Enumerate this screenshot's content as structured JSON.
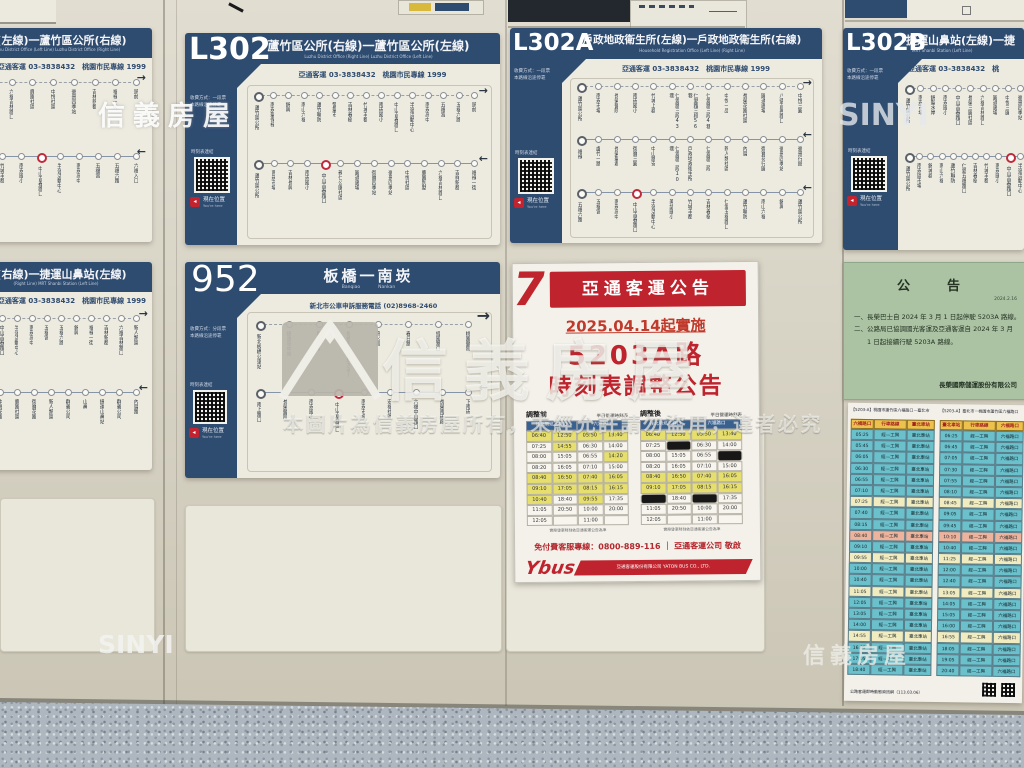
{
  "icons": {
    "arrow_right": "→",
    "arrow_left": "←",
    "here_arrow": "◂",
    "qr": "qr-code",
    "house_logo": "sinyi-house-logo"
  },
  "watermarks": {
    "brand_cn": "信義房屋",
    "brand_en": "SINYI",
    "notice_line": "本圖片為信義房屋所有，未經允許請勿盜用，違者必究"
  },
  "signs": {
    "a_top": {
      "title": "所(左線)一蘆竹區公所(右線)",
      "title_en": "Luzhu District Office (Left Line)   Luzhu District Office (Right Line)",
      "phone": "亞通客運 03-3838432　桃園市民專線 1999",
      "rows": [
        {
          "stops": [
            "西藥花園社區",
            "圓樹廣場",
            "六福吉林路口",
            "鹿園社區",
            "中悅社區",
            "豪景四季站",
            "吉林新都",
            "福祿一街",
            "頭前"
          ],
          "red": -1
        },
        {
          "stops": [
            "仁愛五福路口",
            "吉林春樹",
            "竹城丰都",
            "南崁國小",
            "中山吉春路口",
            "半嶺活動中心",
            "南崁高中",
            "五福宮",
            "五福六路",
            "六福入口"
          ],
          "red": 4
        }
      ]
    },
    "l302": {
      "code": "L302",
      "title": "蘆竹區公所(右線)一蘆竹區公所(左線)",
      "title_en": "Luzhu District Office (Right Line)   Luzhu District Office (Left Line)",
      "phone": "亞通客運 03-3838432　桃園市民專線 1999",
      "fare1": "收費方式：一段票",
      "fare2": "本路線沿途停靠",
      "qr_label": "時刻表連結",
      "here": "現在位置",
      "here_en": "You're here",
      "rows": [
        {
          "stops": [
            "蘆竹區公所",
            "南崁聖保祿",
            "錦興",
            "南山六福",
            "蘆竹聯防",
            "警聖市",
            "吉林春樹",
            "竹城丰都",
            "南崁國小",
            "中山吉春路口",
            "半嶺活動中心",
            "南崁高中",
            "五福宮",
            "五福六路",
            "頭前"
          ],
          "red": -1
        },
        {
          "stops": [
            "蘆竹區公所",
            "南崁市場",
            "吉林長興",
            "南崁國小",
            "中山吉春路口",
            "親仁公園社區",
            "圓通廣場",
            "御寶四季站",
            "豪景四季站",
            "中悅社區",
            "鹿園別墅",
            "六福吉林路口",
            "吉祥新都",
            "福祿一街"
          ],
          "red": 4
        }
      ]
    },
    "l302a": {
      "code": "L302A",
      "title": "戶政地政衛生所(左線)一戶政地政衛生所(右線)",
      "title_en": "Household Registration Office (Left Line)   (Right Line)",
      "phone": "亞通客運 03-3838432　桃園市民專線 1999",
      "fare1": "收費方式：一段票",
      "fare2": "本路線沿途停靠",
      "qr_label": "時刻表連結",
      "here": "現在位置",
      "here_en": "You're here",
      "rows": [
        {
          "stops": [
            "蘆竹區公所",
            "南崁市場",
            "長榮醫院",
            "南崁國小",
            "竹城上郡",
            "仁愛路三段43巷",
            "仁愛路三段56巷",
            "仁愛路三段4巷",
            "中悅一品",
            "長榮花園社區",
            "圓通廣場",
            "八德吉興路口",
            "中悅三圓"
          ],
          "red": -1
        },
        {
          "stops": [
            "福祿",
            "盧竹一路",
            "長榮聖君",
            "御寶三圓",
            "中山路安",
            "仁愛路二段10巷",
            "戶政地政衛生所",
            "仁愛路二段",
            "新人類社區",
            "內厝",
            "御寶花行圓",
            "豪景四季站",
            "豪景行館"
          ],
          "red": -1
        },
        {
          "stops": [
            "五福六路",
            "五福宮",
            "南崁高中",
            "中山吉春路口",
            "半嶺活動中心",
            "美語國小",
            "竹城丰都",
            "吉林春樹",
            "仁愛五福路口",
            "蘆竹聯防",
            "南山六福",
            "錦興",
            "蘆竹區公所"
          ],
          "red": 3
        }
      ]
    },
    "l302b": {
      "code": "L302B",
      "title": "捷運山鼻站(左線)一捷",
      "title_en": "MRT Shanbi Station (Left Line)",
      "phone": "亞通客運 03-3838432　桃",
      "fare1": "收費方式：一段票",
      "fare2": "本路線沿途停靠",
      "qr_label": "時刻表連結",
      "here": "現在位置",
      "here_en": "You're here",
      "rows": [
        {
          "stops": [
            "蘆竹區公所",
            "南崁市場",
            "錦聖水岸",
            "南崁國小",
            "中山吉春路口",
            "長榮三圓社區",
            "六福吉林路口",
            "圓通廣場",
            "中悅三圓",
            "豪景四季站"
          ],
          "red": -1
        },
        {
          "stops": [
            "蘆竹區公所",
            "南崁區市場",
            "錦城郡",
            "南山六福",
            "蘆竹聯防",
            "仁愛五福路口",
            "吉林春樹",
            "竹城丰都",
            "南崁國小",
            "中山吉春路口",
            "半嶺活動中心"
          ],
          "red": 9
        }
      ]
    },
    "a_mid": {
      "title": "站(右線)一捷運山鼻站(左線)",
      "title_en": "(Right Line)   MRT Shanbi Station (Left Line)",
      "phone": "亞通客運 03-3838432　桃園市民專線 1999",
      "rows": [
        {
          "stops": [
            "竹城丰都",
            "南崁國小",
            "中山吉春路口",
            "半嶺活動中心",
            "南崁高中",
            "五福宮",
            "五福六路",
            "錦興",
            "福祿一街",
            "吉林新都",
            "六福吉林路口",
            "新人類區"
          ],
          "red": -1
        },
        {
          "stops": [
            "豪景擴行圓",
            "豪景四季站",
            "中悅花園",
            "鹿園社區",
            "御寶花園",
            "新人類區",
            "群義公司",
            "山鼻",
            "捷運山鼻站",
            "群義公司",
            "內厝路"
          ],
          "red": -1
        }
      ]
    },
    "r952": {
      "code": "952",
      "title": "板橋一南崁",
      "title_en": "Banqiao　　　　Nankan",
      "phone": "新北市公車申訴服務電話 (02)8968-2460",
      "fare1": "收費方式：分段票",
      "fare2": "本路線沿途停靠",
      "qr_label": "時刻表連結",
      "here": "現在位置",
      "here_en": "You're here",
      "rows": [
        {
          "stops": [
            "新北板橋公車站",
            "捷運府中站",
            "縣民廣場",
            "板橋市(縣民大道)",
            "高公局",
            "春日路",
            "經國路口",
            "桃園醫院"
          ],
          "red": -1
        },
        {
          "stops": [
            "南上路口",
            "長榮醫院",
            "南崁國小",
            "中山吉春路口",
            "南崁市場",
            "宏福社區",
            "六福中山路口",
            "長榮南崁廠",
            "下南崁"
          ],
          "red": 3
        }
      ]
    }
  },
  "poster": {
    "logo7": "7",
    "banner": "亞通客運公告",
    "date_line": "2025.04.14起實施",
    "big1": "5203A路",
    "big2": "時刻表調整公告",
    "table_note": "實際發車時刻依亞通客運公告為準",
    "hotline": "免付費客服專線：0800-889-116 ｜ 亞通客運公司 敬啟",
    "ybus": "Ybus",
    "company": "亞通客運股份有限公司 YATON BUS CO., LTD.",
    "tables": [
      {
        "label": "調整前",
        "sub": "平日營運時刻表",
        "cols": [
          "往北勢坑工興口",
          "六福路口"
        ],
        "rows": [
          [
            "06:40",
            "12:50",
            "05:50",
            "13:40"
          ],
          [
            "07:25",
            "14:55",
            "06:30",
            "14:00"
          ],
          [
            "08:00",
            "15:05",
            "06:55",
            "14:20"
          ],
          [
            "08:20",
            "16:05",
            "07:10",
            "15:00"
          ],
          [
            "08:40",
            "16:50",
            "07:40",
            "16:05"
          ],
          [
            "09:10",
            "17:05",
            "08:15",
            "16:15"
          ],
          [
            "10:40",
            "18:40",
            "09:55",
            "17:35"
          ],
          [
            "11:05",
            "20:50",
            "10:00",
            "20:00"
          ],
          [
            "12:05",
            "",
            "11:00",
            ""
          ]
        ],
        "hl": [
          [
            1,
            1,
            1,
            1
          ],
          [
            0,
            1,
            0,
            0
          ],
          [
            0,
            0,
            0,
            1
          ],
          [
            0,
            0,
            0,
            0
          ],
          [
            1,
            1,
            1,
            1
          ],
          [
            1,
            1,
            1,
            1
          ],
          [
            1,
            0,
            1,
            0
          ],
          [
            0,
            0,
            0,
            0
          ],
          [
            0,
            0,
            0,
            0
          ]
        ]
      },
      {
        "label": "調整後",
        "sub": "平日營運時刻表",
        "cols": [
          "往北勢坑工興口",
          "六福路口"
        ],
        "rows": [
          [
            "06:40",
            "12:50",
            "05:50",
            "13:40"
          ],
          [
            "07:25",
            "#",
            "06:30",
            "14:00"
          ],
          [
            "08:00",
            "15:05",
            "06:55",
            "#"
          ],
          [
            "08:20",
            "16:05",
            "07:10",
            "15:00"
          ],
          [
            "08:40",
            "16:50",
            "07:40",
            "16:05"
          ],
          [
            "09:10",
            "17:05",
            "08:15",
            "16:15"
          ],
          [
            "#",
            "18:40",
            "#",
            "17:35"
          ],
          [
            "11:05",
            "20:50",
            "10:00",
            "20:00"
          ],
          [
            "12:05",
            "",
            "11:00",
            ""
          ]
        ],
        "hl": [
          [
            1,
            1,
            1,
            1
          ],
          [
            0,
            0,
            0,
            0
          ],
          [
            0,
            0,
            0,
            0
          ],
          [
            0,
            0,
            0,
            0
          ],
          [
            1,
            1,
            1,
            1
          ],
          [
            1,
            1,
            1,
            1
          ],
          [
            0,
            0,
            0,
            0
          ],
          [
            0,
            0,
            0,
            0
          ],
          [
            0,
            0,
            0,
            0
          ]
        ]
      }
    ]
  },
  "green": {
    "title": "公　告",
    "date": "2024.2.16",
    "l1": "一、長榮巴士自 2024 年 3 月 1 日起停駛 5203A 路線。",
    "l2": "二、公路局已協調國光客運及亞通客運自 2024 年 3 月",
    "l3": "　　1 日起接續行駛 5203A 路線。",
    "sig": "長榮國際儲運股份有限公司"
  },
  "sheet": {
    "cap1": "【5203-A】桃園市蘆竹區六福路口－臺北市",
    "cap2": "【5203-A】臺北市－桃園市蘆竹區六福路口",
    "route_text": "經—工興",
    "footer": "公路客運即時動態資訊網（113.03.06）",
    "tables": [
      {
        "headers": [
          "六福路口",
          "行車路線",
          "臺北車站"
        ],
        "dest": "臺北車站",
        "times": [
          "05:25",
          "05:45",
          "06:05",
          "06:30",
          "06:55",
          "07:10",
          "07:25",
          "07:40",
          "08:15",
          "08:40",
          "09:10",
          "09:55",
          "10:00",
          "10:40",
          "11:05",
          "12:05",
          "13:05",
          "14:00",
          "14:55",
          "16:05",
          "17:05",
          "18:40"
        ],
        "colors": [
          "t",
          "t",
          "t",
          "t",
          "t",
          "t",
          "c",
          "t",
          "t",
          "s",
          "t",
          "c",
          "t",
          "t",
          "c",
          "t",
          "t",
          "t",
          "c",
          "t",
          "t",
          "t"
        ]
      },
      {
        "headers": [
          "臺北車站",
          "行車路線",
          "六福路口"
        ],
        "dest": "六福路口",
        "times": [
          "06:25",
          "06:45",
          "07:05",
          "07:30",
          "07:55",
          "08:10",
          "08:45",
          "09:05",
          "09:45",
          "10:10",
          "10:40",
          "11:25",
          "12:00",
          "12:40",
          "13:05",
          "14:05",
          "15:05",
          "16:00",
          "16:55",
          "18:05",
          "19:05",
          "20:40"
        ],
        "colors": [
          "t",
          "t",
          "t",
          "t",
          "t",
          "t",
          "c",
          "t",
          "t",
          "s",
          "t",
          "c",
          "t",
          "t",
          "c",
          "t",
          "t",
          "t",
          "c",
          "t",
          "t",
          "t"
        ]
      }
    ]
  }
}
